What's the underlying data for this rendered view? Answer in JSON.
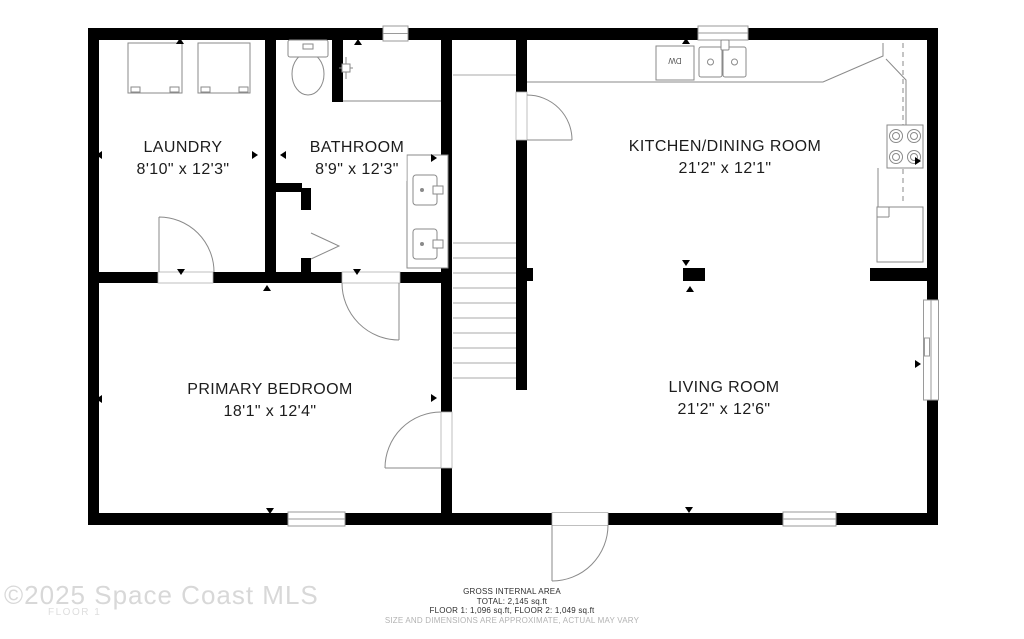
{
  "floorplan": {
    "rooms": [
      {
        "name": "LAUNDRY",
        "dims": "8'10\" x 12'3\""
      },
      {
        "name": "BATHROOM",
        "dims": "8'9\" x 12'3\""
      },
      {
        "name": "KITCHEN/DINING ROOM",
        "dims": "21'2\" x 12'1\""
      },
      {
        "name": "PRIMARY BEDROOM",
        "dims": "18'1\" x 12'4\""
      },
      {
        "name": "LIVING ROOM",
        "dims": "21'2\" x 12'6\""
      }
    ],
    "fixtures": {
      "dishwasher_label": "DW"
    },
    "footer": {
      "title": "GROSS INTERNAL AREA",
      "total": "TOTAL: 2,145 sq.ft",
      "floors": "FLOOR 1: 1,096 sq.ft, FLOOR 2: 1,049 sq.ft",
      "disclaimer": "SIZE AND DIMENSIONS ARE APPROXIMATE, ACTUAL MAY VARY"
    },
    "watermark": {
      "copyright": "©2025 Space Coast MLS",
      "floor": "FLOOR 1"
    }
  },
  "colors": {
    "wall": "#000000",
    "fixture_line": "#8a8a8a",
    "stair_line": "#aaaaaa",
    "watermark": "#d8d8d8"
  }
}
